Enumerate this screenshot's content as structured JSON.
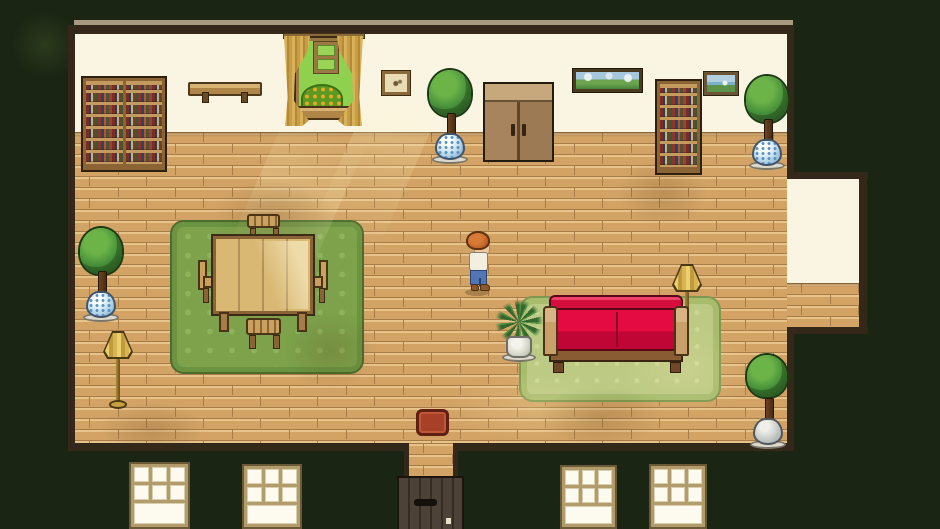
{
  "meta": {
    "type": "game-screenshot",
    "style": "top-down pixel-art RPG",
    "scene_label": "Farmhouse interior with wood-plank floor"
  },
  "palette": {
    "background": "#1b2513",
    "wall": "#faf5e3",
    "trim": "#33281a",
    "floor": "#d2a365",
    "floor_line": "#a87c46",
    "rug_green": "#7da24b",
    "rug_light": "#bcca83",
    "couch_red": "#de0a3f",
    "curtain_gold": "#c79e48",
    "pot_porcelain_blue": "#9cc8e0",
    "lamp_gold": "#d8b455",
    "door_white": "#fdfbef",
    "entry_door_gray": "#4c4238",
    "doormat_red": "#a84028"
  },
  "room": {
    "label": "Living room",
    "wall_section": "cream plaster wall, top",
    "floor_section": "tan brick-laid wood planks",
    "alcove": "right-side alcove bump-out",
    "exit": "bottom-center doorway with dark front door"
  },
  "objects": {
    "double_bookshelf": {
      "label": "Double bookshelf with books"
    },
    "bookshelf": {
      "label": "Bookshelf with books"
    },
    "wall_shelf": {
      "label": "Wooden wall shelf"
    },
    "window": {
      "label": "Window with gold curtains and flowering bush outside"
    },
    "small_picture": {
      "label": "Small framed sketch"
    },
    "wide_painting": {
      "label": "Wide landscape painting"
    },
    "sea_painting": {
      "label": "Framed landscape picture"
    },
    "wardrobe": {
      "label": "Wooden wardrobe cabinet"
    },
    "potted_tree": {
      "label": "Potted topiary tree in porcelain pot"
    },
    "potted_tree_gray": {
      "label": "Potted topiary tree in stone pot"
    },
    "floor_lamp": {
      "label": "Brass floor lamp"
    },
    "dining_rug": {
      "label": "Green patterned rug"
    },
    "dining_table": {
      "label": "Wooden dining table"
    },
    "chair": {
      "label": "Wooden chair"
    },
    "fern": {
      "label": "Potted fern plant"
    },
    "couch_rug": {
      "label": "Light green rug"
    },
    "couch": {
      "label": "Red couch with wooden arms"
    },
    "doormat": {
      "label": "Red doormat"
    },
    "entry_door": {
      "label": "Dark front door"
    },
    "white_door": {
      "label": "White paneled door with six panes"
    }
  },
  "character": {
    "label": "Player character",
    "facing": "right",
    "hair_color": "#c4662a",
    "shirt_color": "#f2eee0",
    "pants_color": "#5276b4",
    "shoes_color": "#8a5a2c"
  }
}
